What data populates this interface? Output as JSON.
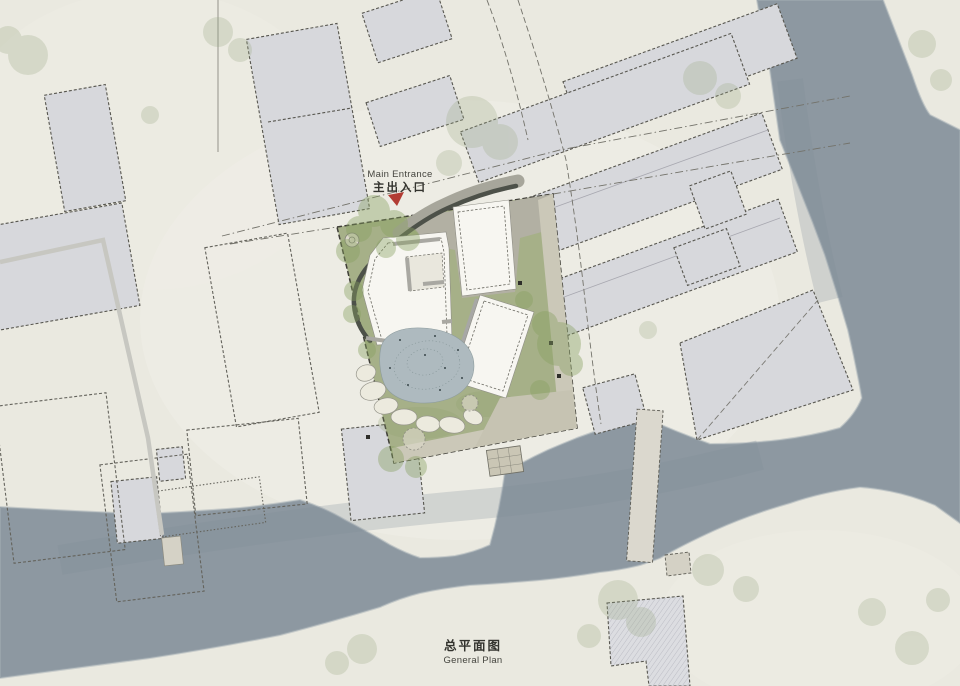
{
  "labels": {
    "main_entrance_en": "Main Entrance",
    "main_entrance_zh": "主出入口",
    "plan_title_zh": "总平面图",
    "plan_title_en": "General Plan"
  },
  "colors": {
    "paper": "#eae9e0",
    "river": "#8d98a1",
    "river_edge": "#a5afb6",
    "lawn": "#a6b088",
    "site_path": "#cbc8b8",
    "plaza": "#b2b0a3",
    "context_building": "#d7d8dc",
    "site_building": "#f7f6f1",
    "pond": "#aebabf",
    "stone": "#eceade",
    "dark_wall": "#4d5149",
    "tree_green": "#87a060",
    "context_tree": "#9aa984",
    "entrance_marker": "#b23c33",
    "text_dark": "#33332e",
    "text_gray": "#45453f"
  }
}
